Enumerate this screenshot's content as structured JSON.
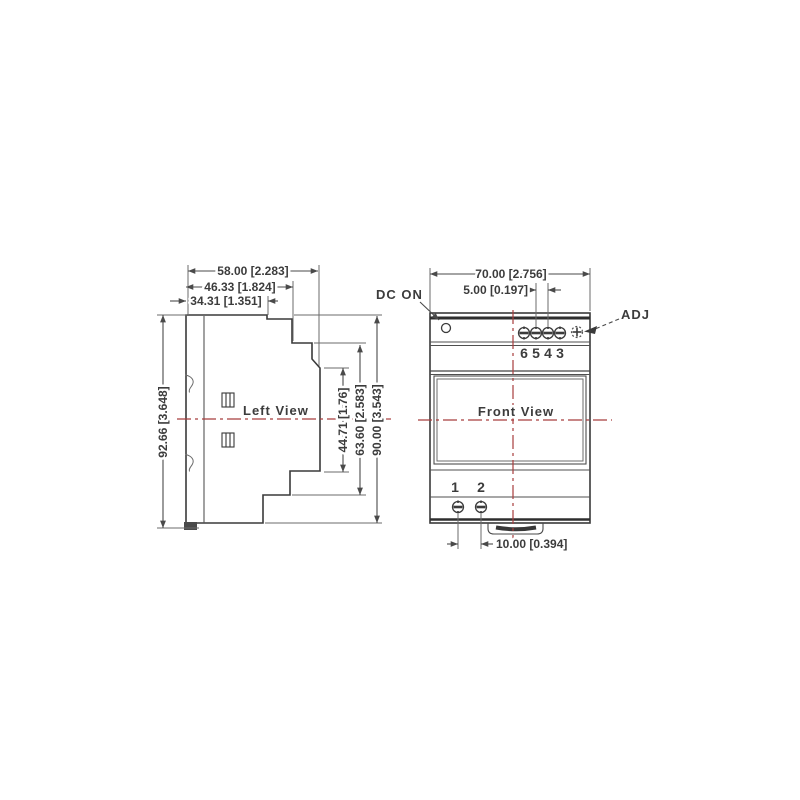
{
  "drawing": {
    "left_view": {
      "title": "Left View",
      "dim_depth_total": "58.00 [2.283]",
      "dim_depth_upper": "46.33 [1.824]",
      "dim_depth_top": "34.31 [1.351]",
      "dim_height_overall": "92.66 [3.648]",
      "dim_height_front": "44.71 [1.76]",
      "dim_height_step": "63.60 [2.583]",
      "dim_height_body": "90.00 [3.543]"
    },
    "front_view": {
      "title": "Front View",
      "dim_width": "70.00 [2.756]",
      "dim_terminal_pitch": "5.00 [0.197]",
      "dim_bottom_terminal_pitch": "10.00 [0.394]",
      "label_dc_on": "DC ON",
      "label_adj": "ADJ",
      "top_terminal_numbers": [
        "6",
        "5",
        "4",
        "3"
      ],
      "bottom_terminal_numbers": [
        "1",
        "2"
      ]
    },
    "colors": {
      "line": "#3a3a3a",
      "centerline_red": "#a83d3d",
      "background": "#ffffff"
    }
  }
}
